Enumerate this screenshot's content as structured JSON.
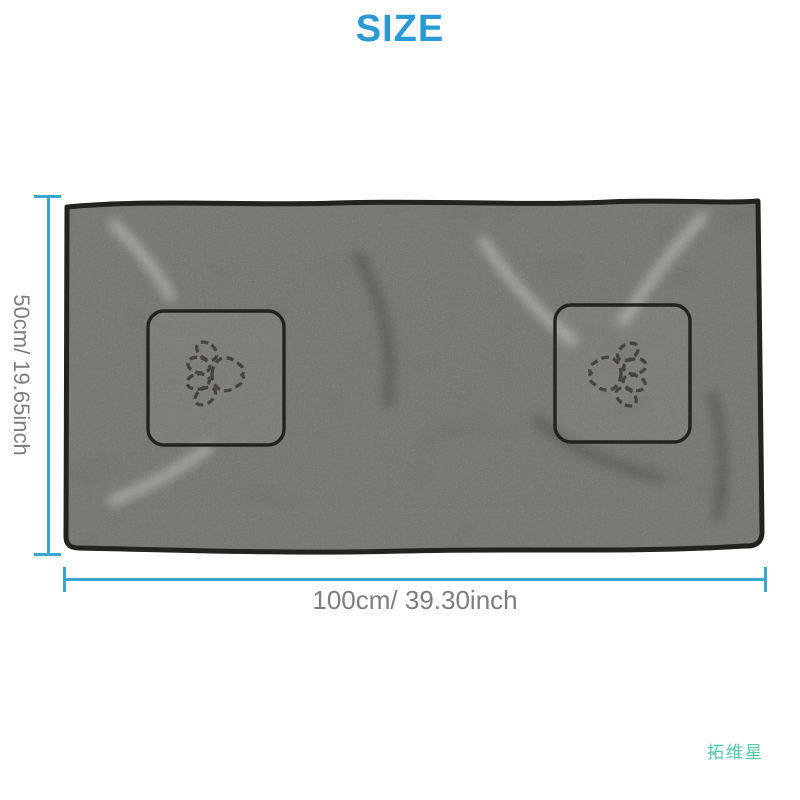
{
  "title": "SIZE",
  "dimensions": {
    "height_label": "50cm/ 19.65inch",
    "width_label": "100cm/ 39.30inch"
  },
  "brand_text": "拓维星",
  "colors": {
    "title": "#2b9ad3",
    "dimension_line": "#39a7cb",
    "dimension_text": "#7d7d7d",
    "brand": "#4fcba6",
    "towel_base": "#95948c",
    "towel_trim": "#23221e",
    "stitch": "#3f3d36"
  }
}
